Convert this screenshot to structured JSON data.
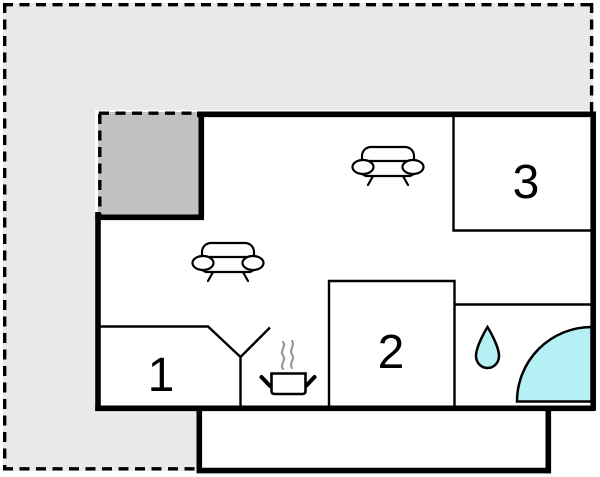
{
  "floorplan": {
    "type": "floor-plan",
    "rooms": [
      {
        "name": "room-1",
        "label": "1"
      },
      {
        "name": "room-2",
        "label": "2"
      },
      {
        "name": "room-3",
        "label": "3"
      }
    ],
    "features": [
      "sofa-icon",
      "sofa-icon",
      "stove-pot-icon",
      "steam-icon",
      "water-drop-icon",
      "shower-quarter-circle-icon"
    ],
    "colors": {
      "plot-fill": "#e9e9e9",
      "annex-fill": "#c1c1c1",
      "interior-fill": "#ffffff",
      "wall": "#000000",
      "water": "#b5f0f4",
      "steam": "#999999"
    }
  }
}
